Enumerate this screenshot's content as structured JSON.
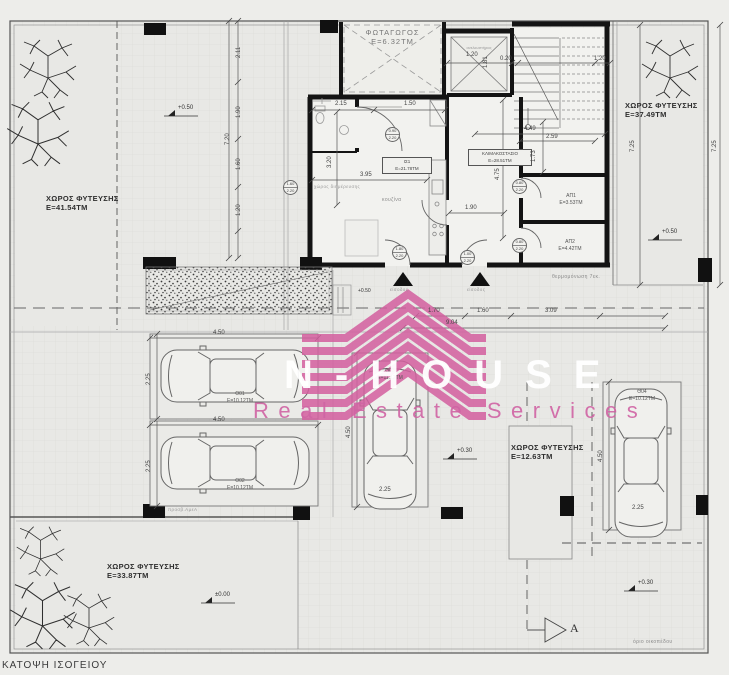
{
  "page": {
    "caption": "ΚΑΤΟΨΗ ΙΣΟΓΕΙΟΥ"
  },
  "watermark": {
    "brand": "N-HOUSE",
    "tagline": "Real Estate Services",
    "pink": "#d45f9f"
  },
  "planting": [
    {
      "label": "ΧΩΡΟΣ ΦΥΤΕΥΣΗΣ",
      "area": "Ε=41.54ΤΜ"
    },
    {
      "label": "ΧΩΡΟΣ ΦΥΤΕΥΣΗΣ",
      "area": "Ε=37.49ΤΜ"
    },
    {
      "label": "ΧΩΡΟΣ ΦΥΤΕΥΣΗΣ",
      "area": "Ε=12.63ΤΜ"
    },
    {
      "label": "ΧΩΡΟΣ ΦΥΤΕΥΣΗΣ",
      "area": "Ε=33.87ΤΜ"
    }
  ],
  "rooms": {
    "lightwell": {
      "name": "ΦΩΤΑΓΩΓΟΣ",
      "area": "Ε=6.32ΤΜ"
    },
    "unit": {
      "name": "ΙΣ1",
      "area": "Ε=21.78ΤΜ"
    },
    "stairwell": {
      "name": "ΚΛΙΜΑΚΟΣΤΑΣΙΟ",
      "area": "Ε=28.51ΤΜ"
    },
    "storage1": {
      "name": "ΑΠ1",
      "area": "Ε=3.53ΤΜ"
    },
    "storage2": {
      "name": "ΑΠ2",
      "area": "Ε=4.42ΤΜ"
    },
    "kitchen": "κουζίνα",
    "living": "χώρος διημέρευσης",
    "elevator": "ανελκυστήρας"
  },
  "parking": [
    {
      "name": "Θ01",
      "area": "Ε=10.12ΤΜ",
      "len": "4.50",
      "wid": "2.25"
    },
    {
      "name": "Θ02",
      "area": "Ε=10.12ΤΜ",
      "len": "4.50",
      "wid": "2.25"
    },
    {
      "name": "Θ03",
      "area": "Ε=11.12ΤΜ",
      "len": "4.50",
      "wid": "2.25"
    },
    {
      "name": "Θ04",
      "area": "Ε=10.12ΤΜ",
      "len": "4.50",
      "wid": "2.25"
    }
  ],
  "levels": {
    "terrace": "+0.50",
    "entry": "+0.50",
    "ne": "+0.50",
    "mid": "+0.30",
    "right": "+0.30",
    "ground": "±0.00"
  },
  "dims": {
    "v1": "2.11",
    "v2": "1.90",
    "v3": "1.60",
    "v4": "1.20",
    "vtot": "7.20",
    "bath_w": "2.15",
    "hall_w": "1.50",
    "unit_w": "3.95",
    "unit_h": "3.20",
    "cor_w": "1.90",
    "stair_h": "4.75",
    "stair_w": "4.49",
    "flight": "1.73",
    "stair_top": "2.59",
    "elev_w": "1.20",
    "elev_h": "1.81",
    "e1": "0.20",
    "e2": "1.20",
    "s1": "1.70",
    "s2": "1.60",
    "s3": "3.09",
    "stot": "9.04",
    "ne_h": "7.25",
    "right_h": "7.25"
  },
  "door_tags": [
    {
      "w": "1.60",
      "h": "2.20"
    },
    {
      "w": "0.90",
      "h": "2.20"
    },
    {
      "w": "1.80",
      "h": "2.20"
    },
    {
      "w": "1.00",
      "h": "2.20"
    },
    {
      "w": "0.80",
      "h": "2.20"
    },
    {
      "w": "0.80",
      "h": "2.20"
    }
  ],
  "annotations": {
    "entrance": "είσοδος",
    "insulation": "θερμομόνωση 7εκ.",
    "plot_boundary": "όριο οικοπέδου",
    "section": "A",
    "access": "προσβ.ΑμεΑ"
  }
}
